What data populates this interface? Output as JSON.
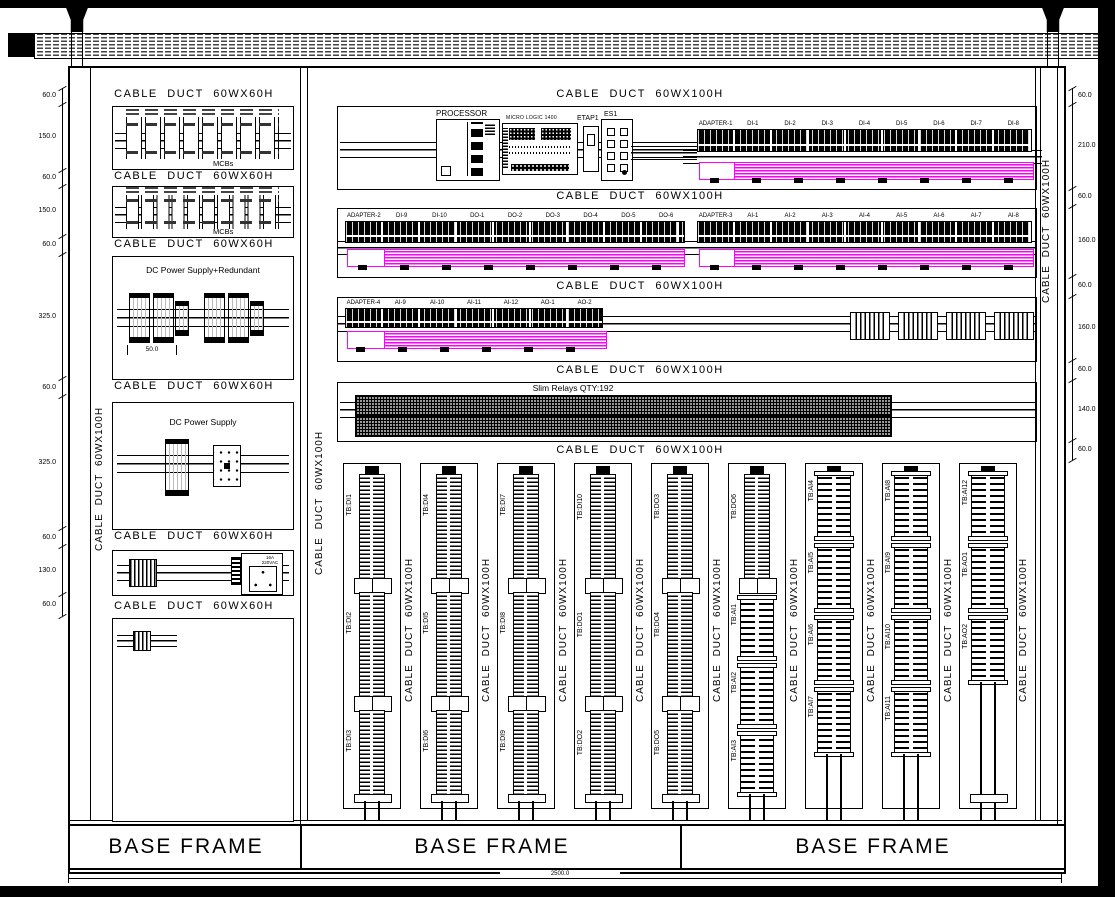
{
  "labels": {
    "duct60": "CABLE DUCT 60WX60H",
    "duct100": "CABLE DUCT 60WX100H",
    "mcbs": "MCBs",
    "dc_red": "DC Power Supply+Redundant",
    "dc_sup": "DC Power Supply",
    "psu_dim": "50.0",
    "socket": "16A\n220VAC",
    "processor": "PROCESSOR",
    "micrologic": "MICRO LOGIC 1400",
    "etap": "ETAP1",
    "es": "ES1",
    "relays": "Slim Relays QTY:192",
    "base": "BASE FRAME"
  },
  "dims": {
    "left": [
      "60.0",
      "150.0",
      "60.0",
      "150.0",
      "60.0",
      "325.0",
      "60.0",
      "325.0",
      "60.0",
      "130.0",
      "60.0"
    ],
    "right": [
      "60.0",
      "210.0",
      "60.0",
      "160.0",
      "60.0",
      "160.0",
      "60.0",
      "140.0",
      "60.0"
    ],
    "bottom": "2500.0"
  },
  "strips": {
    "row1": [
      "ADAPTER-1",
      "DI-1",
      "DI-2",
      "DI-3",
      "DI-4",
      "DI-5",
      "DI-6",
      "DI-7",
      "DI-8"
    ],
    "row2_left": [
      "ADAPTER-2",
      "DI-9",
      "DI-10",
      "DO-1",
      "DO-2",
      "DO-3",
      "DO-4",
      "DO-5",
      "DO-6"
    ],
    "row2_right": [
      "ADAPTER-3",
      "AI-1",
      "AI-2",
      "AI-3",
      "AI-4",
      "AI-5",
      "AI-6",
      "AI-7",
      "AI-8"
    ],
    "row3_left": [
      "ADAPTER-4",
      "AI-9",
      "AI-10",
      "AI-11",
      "AI-12",
      "AO-1",
      "AO-2"
    ]
  },
  "tb_columns": [
    [
      "TB:DI1",
      "TB:DI2",
      "TB:DI3"
    ],
    [
      "TB:DI4",
      "TB:DI5",
      "TB:DI6"
    ],
    [
      "TB:DI7",
      "TB:DI8",
      "TB:DI9"
    ],
    [
      "TB:DI10",
      "TB:DO1",
      "TB:DO2"
    ],
    [
      "TB:DO3",
      "TB:DO4",
      "TB:DO5"
    ],
    [
      "TB:DO6",
      "TB:AI1",
      "TB:AI2",
      "TB:AI3"
    ],
    [
      "TB:AI4",
      "TB:AI5",
      "TB:AI6",
      "TB:AI7"
    ],
    [
      "TB:AI8",
      "TB:AI9",
      "TB:AI10",
      "TB:AI11"
    ],
    [
      "TB:AI12",
      "TB:AO1",
      "TB:AO2"
    ]
  ],
  "colors": {
    "wire_duct": "#ff00ff",
    "line": "#000000"
  }
}
